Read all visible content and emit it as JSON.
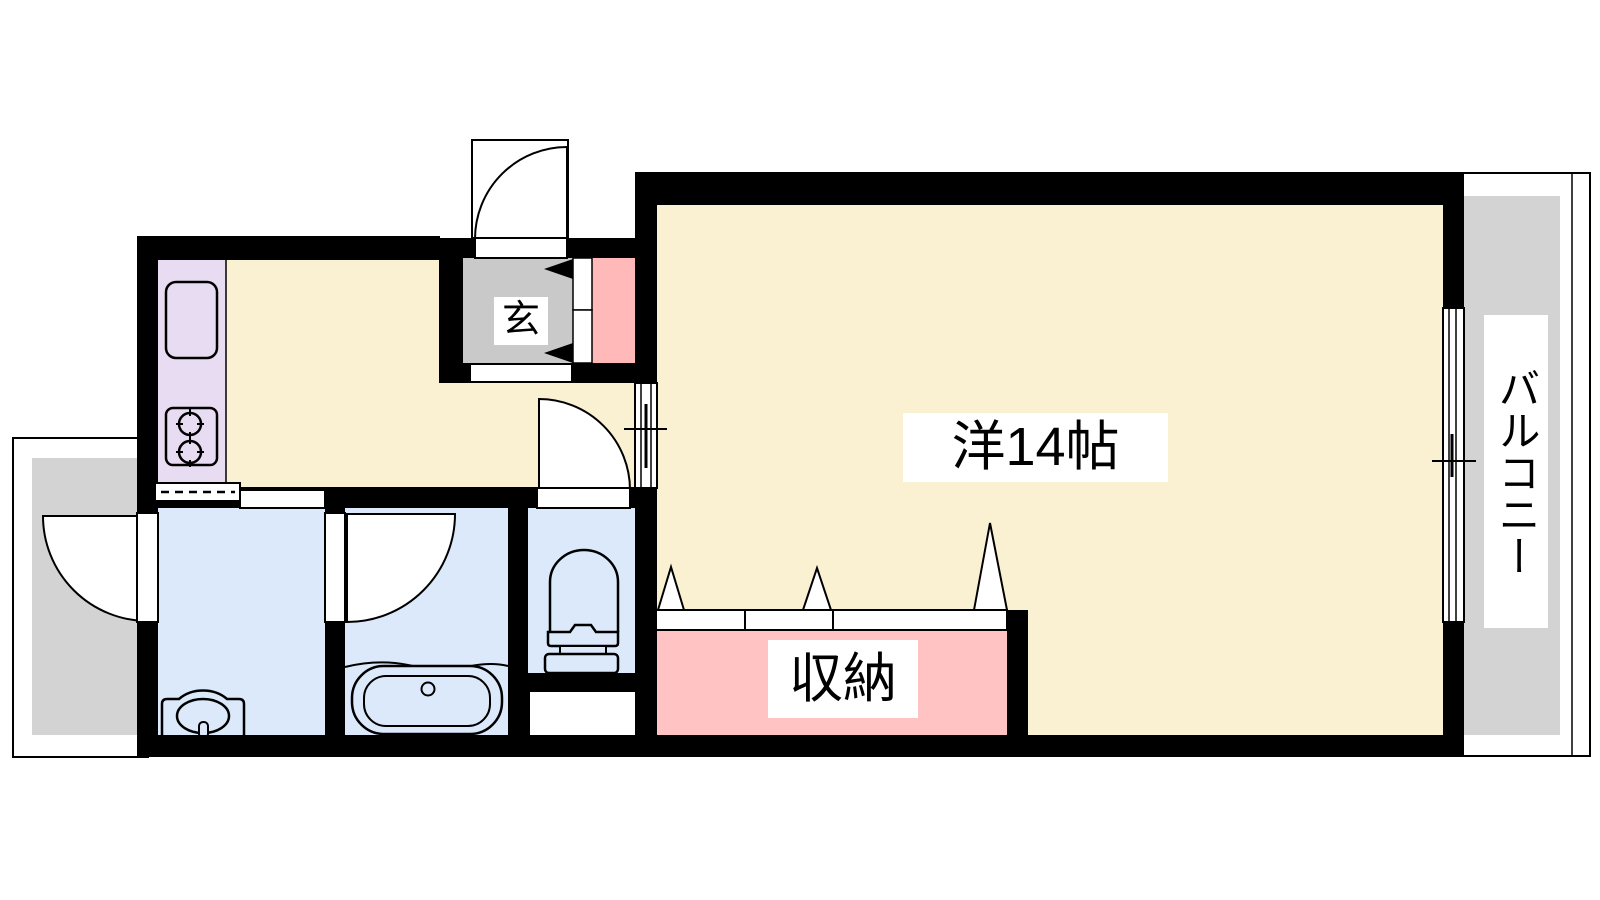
{
  "document": {
    "type": "apartment-floor-plan"
  },
  "labels": {
    "main_room": "洋14帖",
    "storage": "収納",
    "balcony": "バルコニー",
    "entrance": "玄"
  },
  "colors": {
    "floor_cream": "#FAF0D2",
    "storage_pink": "#FFC3C3",
    "entrance_pink": "#FFB9B9",
    "genkan_gray": "#C9C9C9",
    "balcony_gray": "#D3D3D3",
    "wet_blue": "#DCE9FA",
    "counter_purple": "#E8DCF2",
    "wall_black": "#000000",
    "label_bg": "#FFFFFF"
  }
}
